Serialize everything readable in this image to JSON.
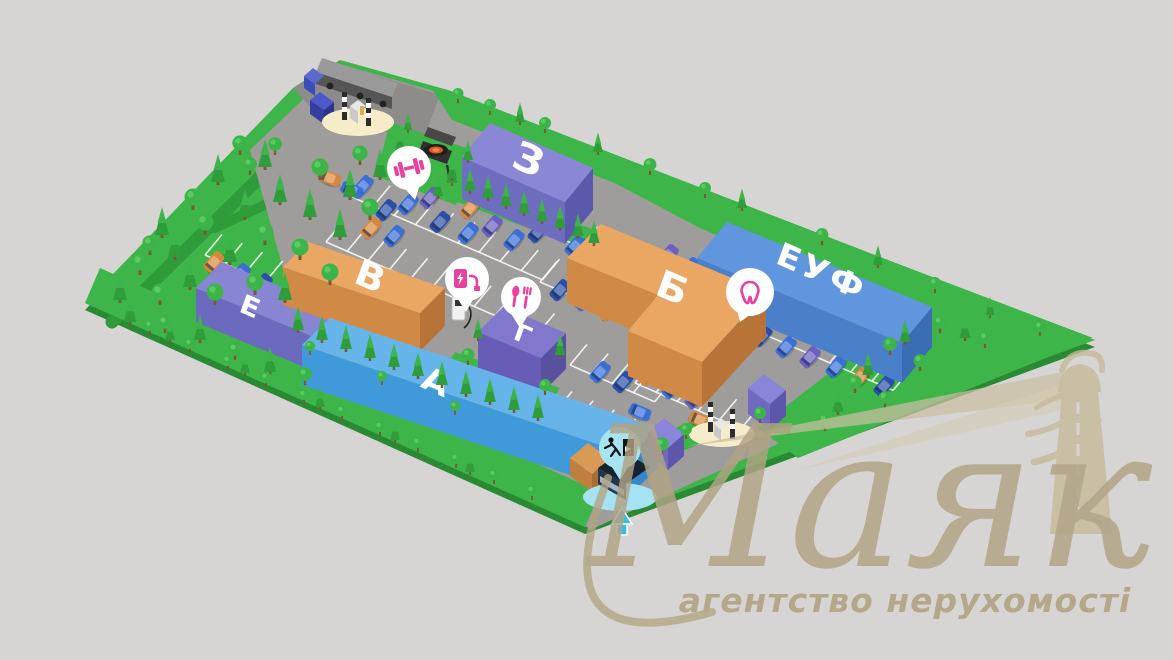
{
  "page": {
    "background_color": "#d6d5d3"
  },
  "site_plan": {
    "terrain_color": "#3eb548",
    "road_color": "#9e9d9b",
    "buildings": [
      {
        "id": "building-z",
        "label": "З",
        "roof_color": "#8a88d6",
        "front_color": "#6f6dbf",
        "side_color": "#5b59ab"
      },
      {
        "id": "building-v",
        "label": "В",
        "roof_color": "#eaa763",
        "front_color": "#d18a45",
        "side_color": "#b87438"
      },
      {
        "id": "building-b",
        "label": "Б",
        "roof_color": "#eaa763",
        "front_color": "#d18a45",
        "side_color": "#b87438"
      },
      {
        "id": "building-euf",
        "label": "ЕУФ",
        "roof_color": "#6096dd",
        "front_color": "#4a80c9",
        "side_color": "#3a6db3"
      },
      {
        "id": "building-e",
        "label": "Е",
        "roof_color": "#8886d3",
        "front_color": "#6c6abe",
        "side_color": "#5a58aa"
      },
      {
        "id": "building-a",
        "label": "А",
        "roof_color": "#66b4ea",
        "front_color": "#409ad9",
        "side_color": "#3788c8"
      },
      {
        "id": "building-g",
        "label": "Г",
        "roof_color": "#8177cc",
        "front_color": "#685db6",
        "side_color": "#5751a0"
      }
    ],
    "amenities": [
      {
        "id": "gym",
        "icon": "dumbbell-icon",
        "color": "#e8429e",
        "badge_color": "#ffffff"
      },
      {
        "id": "ev-charging",
        "icon": "ev-charger-icon",
        "color": "#e8429e",
        "badge_color": "#ffffff"
      },
      {
        "id": "restaurant",
        "icon": "cutlery-icon",
        "color": "#e8429e",
        "badge_color": "#ffffff"
      },
      {
        "id": "dental",
        "icon": "tooth-icon",
        "color": "#e8429e",
        "badge_color": "#ffffff"
      },
      {
        "id": "emergency-exit",
        "icon": "exit-run-icon",
        "color": "#141414",
        "badge_color": "#a8e4ef"
      },
      {
        "id": "bus-stop",
        "icon": "bus-stop-marker",
        "color": "#38bce6",
        "badge_color": "#a5e2f2"
      }
    ],
    "checkpoints": [
      {
        "id": "gate-north",
        "icon": "security-barrier-icon"
      },
      {
        "id": "gate-south",
        "icon": "security-barrier-icon"
      }
    ],
    "features": [
      {
        "id": "delivery-truck",
        "icon": "truck-icon"
      },
      {
        "id": "bbq-area",
        "icon": "grill-icon"
      },
      {
        "id": "ev-station",
        "icon": "charging-post-icon"
      },
      {
        "id": "bus-shelter",
        "icon": "bus-shelter-icon"
      }
    ]
  },
  "watermark": {
    "brand": "Маяк",
    "tagline": "агентство нерухомості",
    "color": "#b2a483",
    "lighthouse_icon": "lighthouse-icon"
  }
}
